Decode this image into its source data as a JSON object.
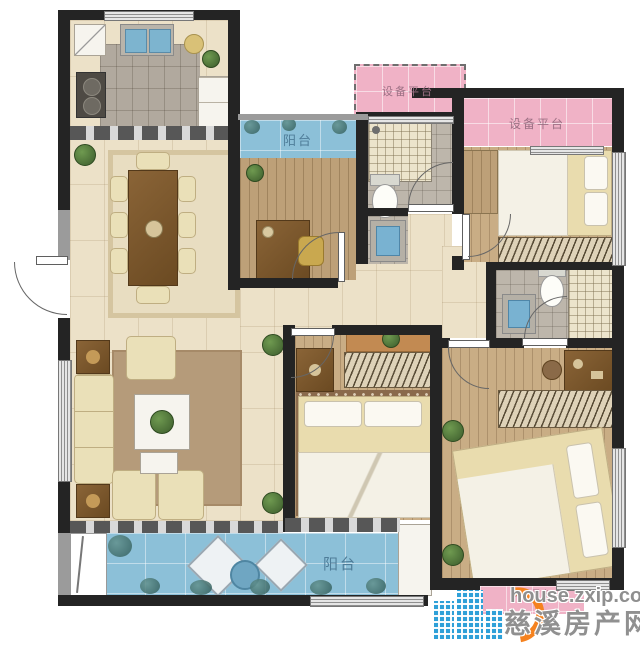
{
  "canvas": {
    "width": 640,
    "height": 640
  },
  "labels": {
    "balcony_top": "阳台",
    "balcony_bottom": "阳台",
    "platform_top_left": "设备平台",
    "platform_top_right": "设备平台",
    "platform_bottom_right": "设备平台"
  },
  "watermark": {
    "site": "house.zxip.com",
    "brand": "慈溪房产网"
  },
  "colors": {
    "wall": "#242424",
    "floor_cream": "#ece1c8",
    "floor_wood": "#c9ad85",
    "kitchen_tile": "#b1a99e",
    "balcony_blue": "#8cc0d8",
    "platform_pink": "#f0b2c6",
    "rug_tan": "#b59b7a",
    "balcony_label": "#4f7d99",
    "platform_label": "#9c7084",
    "watermark_gray": "#8f8f8f",
    "logo_blue": "#2ea0d8",
    "logo_orange": "#f5821f"
  },
  "icons": {
    "logo_buildings": "city-buildings-icon",
    "logo_ring": "orange-ring-icon"
  }
}
